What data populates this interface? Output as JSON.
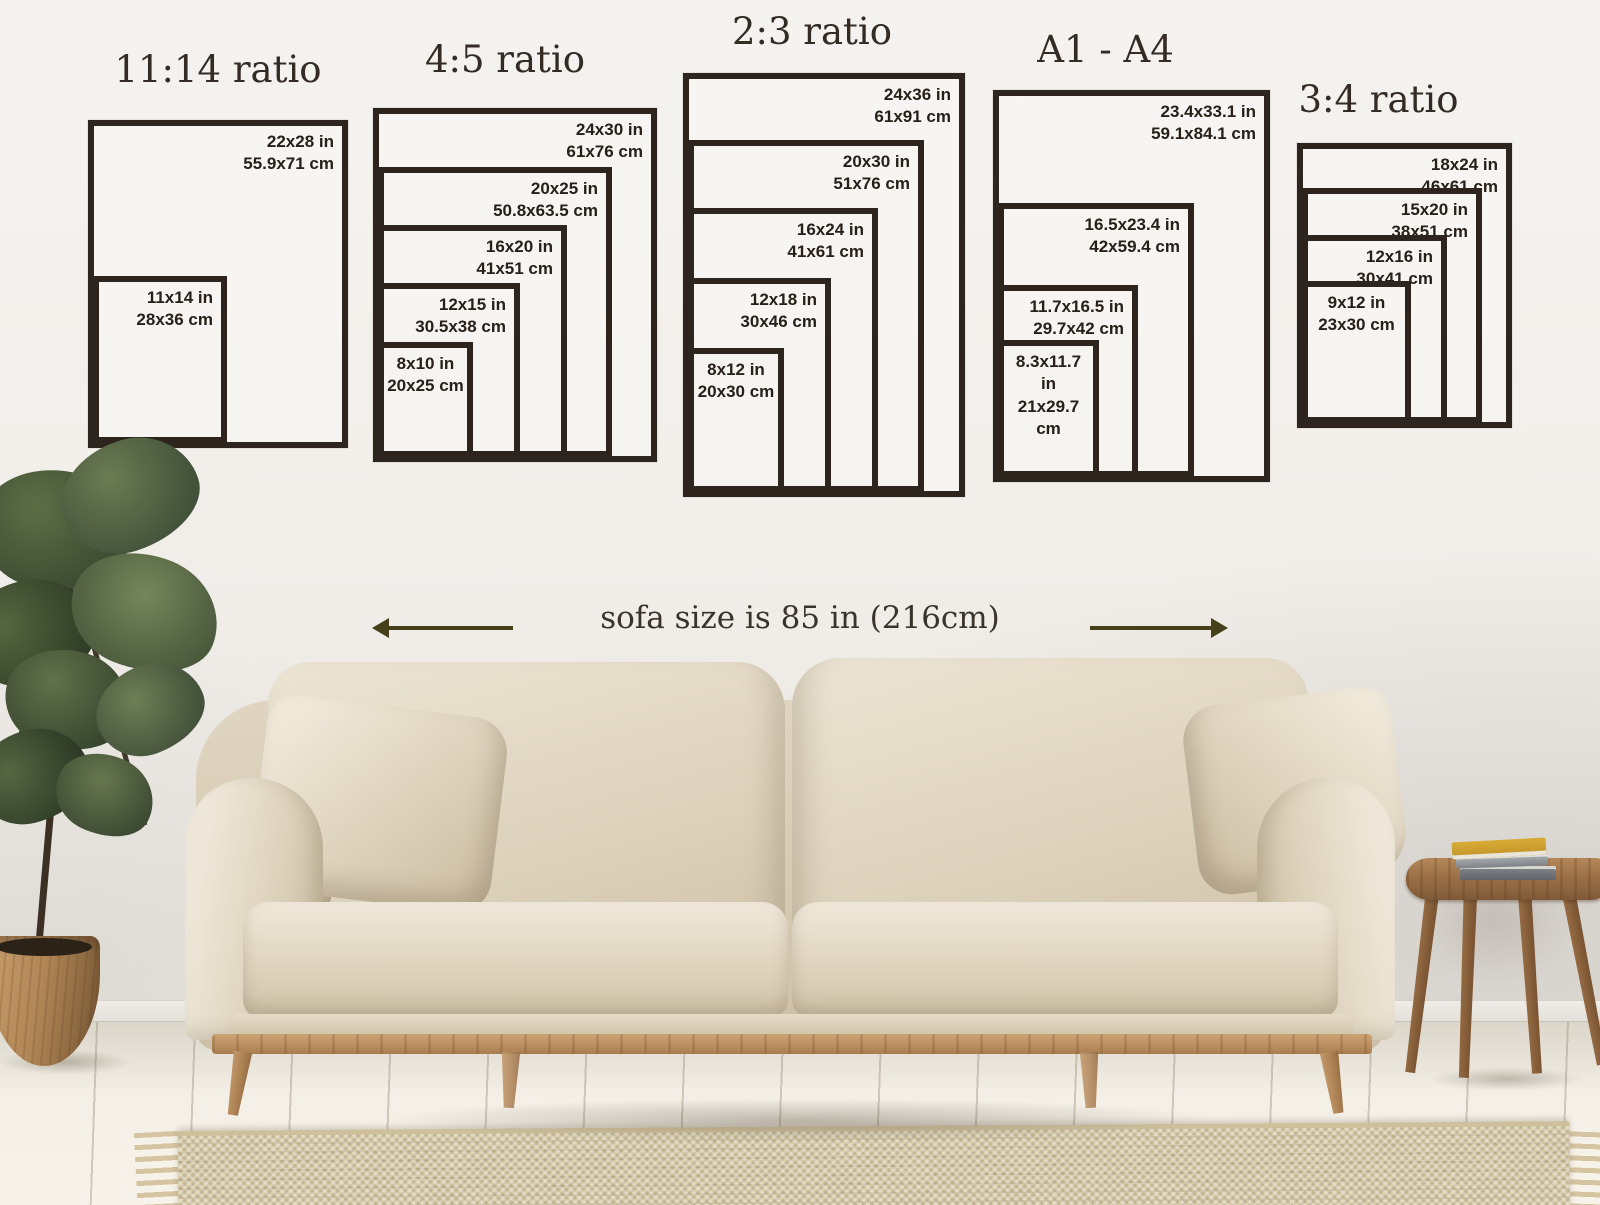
{
  "size_guide": {
    "frame_color": "#2d241d",
    "label_color": "#272019",
    "title_color": "#332b24",
    "groups": [
      {
        "id": "ratio-11-14",
        "title": "11:14 ratio",
        "frames": [
          {
            "in": "22x28 in",
            "cm": "55.9x71 cm"
          },
          {
            "in": "11x14 in",
            "cm": "28x36 cm"
          }
        ]
      },
      {
        "id": "ratio-4-5",
        "title": "4:5 ratio",
        "frames": [
          {
            "in": "24x30 in",
            "cm": "61x76 cm"
          },
          {
            "in": "20x25 in",
            "cm": "50.8x63.5 cm"
          },
          {
            "in": "16x20 in",
            "cm": "41x51 cm"
          },
          {
            "in": "12x15 in",
            "cm": "30.5x38 cm"
          },
          {
            "in": "8x10 in",
            "cm": "20x25 cm"
          }
        ]
      },
      {
        "id": "ratio-2-3",
        "title": "2:3 ratio",
        "frames": [
          {
            "in": "24x36 in",
            "cm": "61x91 cm"
          },
          {
            "in": "20x30 in",
            "cm": "51x76 cm"
          },
          {
            "in": "16x24 in",
            "cm": "41x61 cm"
          },
          {
            "in": "12x18 in",
            "cm": "30x46 cm"
          },
          {
            "in": "8x12 in",
            "cm": "20x30 cm"
          }
        ]
      },
      {
        "id": "a-series",
        "title": "A1 - A4",
        "frames": [
          {
            "in": "23.4x33.1 in",
            "cm": "59.1x84.1 cm"
          },
          {
            "in": "16.5x23.4 in",
            "cm": "42x59.4 cm"
          },
          {
            "in": "11.7x16.5 in",
            "cm": "29.7x42 cm"
          },
          {
            "in": "8.3x11.7 in",
            "cm": "21x29.7 cm"
          }
        ]
      },
      {
        "id": "ratio-3-4",
        "title": "3:4 ratio",
        "frames": [
          {
            "in": "18x24 in",
            "cm": "46x61 cm"
          },
          {
            "in": "15x20 in",
            "cm": "38x51 cm"
          },
          {
            "in": "12x16 in",
            "cm": "30x41 cm"
          },
          {
            "in": "9x12 in",
            "cm": "23x30 cm"
          }
        ]
      }
    ]
  },
  "sofa_note": {
    "text": "sofa size is 85 in (216cm)",
    "arrow_color": "#454019"
  }
}
